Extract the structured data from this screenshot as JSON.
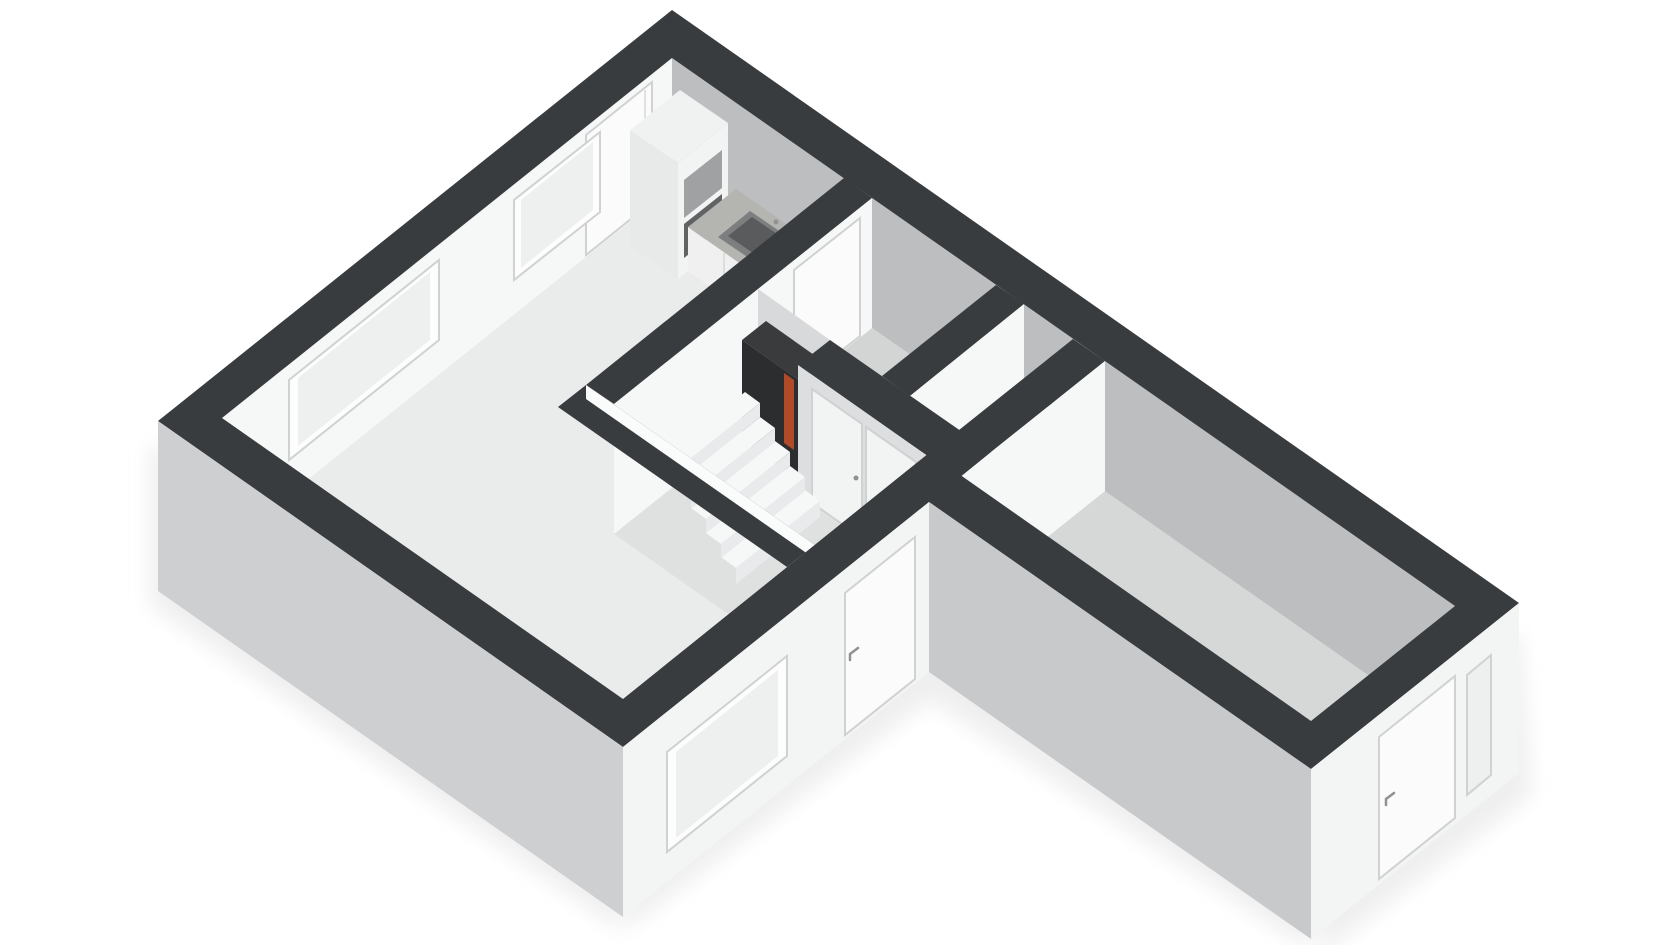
{
  "scene": {
    "title": "3D floor plan - axonometric view",
    "background": "#ffffff",
    "render_style": "white model with dark wall caps, viewed from the south above"
  },
  "palette": {
    "bg": "#ffffff",
    "band": "#393c3f",
    "floorLiving": "#eaebeb",
    "floorRoom": "#d3d5d5",
    "floorHall": "#dfe1e1",
    "floorWing": "#d6d8d8",
    "floorNiche": "#cfd1d1",
    "wallGrey": "#bcbec0",
    "wallWhite": "#f6f7f7",
    "extSwMain": "#cdcfd1",
    "extSwWing": "#c7c9cb",
    "extSe": "#f3f4f4",
    "strip": "#fafbfb",
    "stripFaint": "#f0f1f1",
    "counterTop": "#b4b5b1",
    "counterFront": "#eff0ef",
    "sinkOuter": "#7c7e80",
    "sinkInner": "#595b5d",
    "unitTop": "#f0f1f1",
    "unitSe": "#f2f3f3",
    "unitSw": "#e8eaea",
    "applianceUpper": "#9fa1a3",
    "applianceLower": "#606264",
    "equipBody": "#2c2d2f",
    "equipTop": "#3a3b3d",
    "equipAccent": "#b04a28",
    "tread": "#f6f7f7",
    "riser": "#e9eaeb",
    "door": "#fbfbfb",
    "doorPanel": "#f2f3f3",
    "closetFace": "#dcdedf",
    "nicheBack": "#d7d9da",
    "windowOpening": "#fdfdfd",
    "windowGlass": "#eef0f0",
    "frame": "#cfd1d2",
    "handle": "#8f9193",
    "shadow": "#e4e5e6"
  },
  "rooms": [
    "living-room-with-open-kitchen",
    "bathroom",
    "storage-room",
    "hallway-with-winder-stairs",
    "elongated-side-room-wing"
  ],
  "fixtures": {
    "kitchen": [
      "tall-cabinet-with-built-in-appliances",
      "counter-with-sink"
    ],
    "hallway": [
      "winder-staircase",
      "technical-cabinet-with-heater"
    ],
    "stairs_steps": 5
  },
  "openings": {
    "windows": [
      "northwest-large",
      "northwest-small",
      "front-southeast",
      "wing-end-sidelight"
    ],
    "doors": [
      "entrance-door-northwest",
      "bathroom-door",
      "hallway-closet-doors",
      "side-door-southeast",
      "wing-end-door"
    ]
  }
}
